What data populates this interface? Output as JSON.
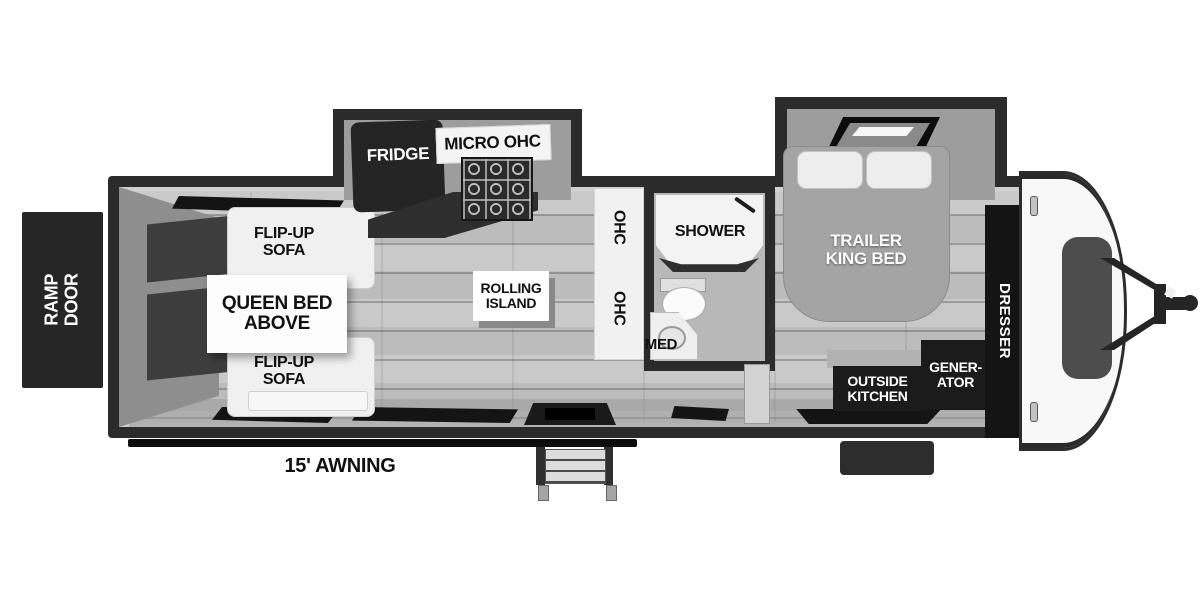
{
  "exterior": {
    "ramp_door": "RAMP\nDOOR",
    "awning": "15' AWNING"
  },
  "garage": {
    "sofa_top": "FLIP-UP\nSOFA",
    "sofa_bottom": "FLIP-UP\nSOFA",
    "queen_bed": "QUEEN BED\nABOVE"
  },
  "kitchen": {
    "fridge": "FRIDGE",
    "micro": "MICRO OHC",
    "island": "ROLLING\nISLAND",
    "ohc_upper": "OHC",
    "ohc_lower": "OHC"
  },
  "bath": {
    "shower": "SHOWER",
    "med": "MED"
  },
  "bedroom": {
    "king_bed": "TRAILER\nKING BED",
    "dresser": "DRESSER",
    "outside_kitchen": "OUTSIDE\nKITCHEN",
    "generator": "GENER-\nATOR"
  },
  "colors": {
    "wall": "#2b2b2b",
    "floor": "#c2c2c2",
    "slide_interior": "#9d9d9d",
    "dark_block": "#1b1b1b",
    "white_fixture": "#f0f0f0"
  }
}
